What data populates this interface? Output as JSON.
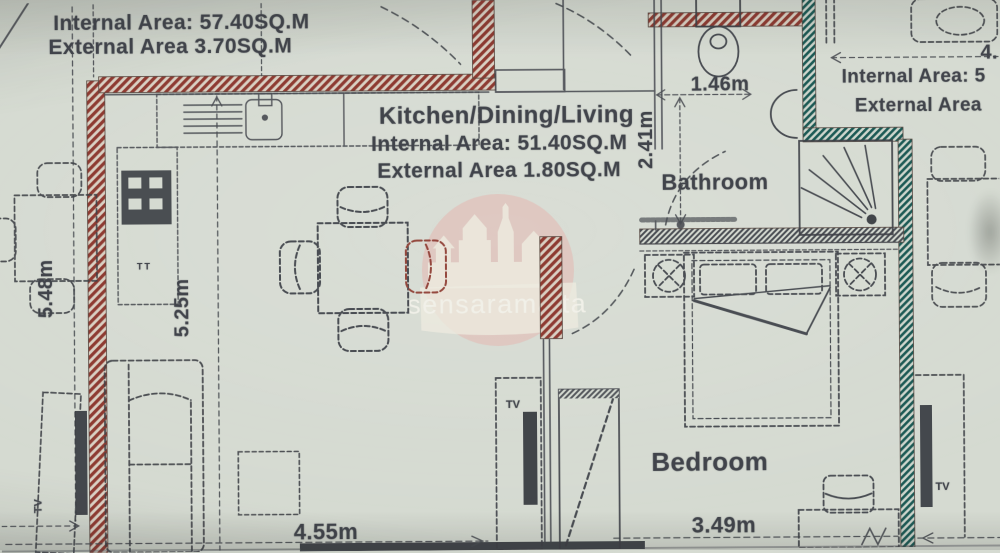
{
  "watermark": {
    "text": "sensaramalta"
  },
  "left_block": {
    "internal": "Internal Area: 57.40SQ.M",
    "external": "External Area 3.70SQ.M"
  },
  "kitchen": {
    "title": "Kitchen/Dining/Living",
    "internal": "Internal Area: 51.40SQ.M",
    "external": "External Area 1.80SQ.M"
  },
  "bathroom": {
    "label": "Bathroom"
  },
  "bedroom": {
    "label": "Bedroom"
  },
  "right_block": {
    "internal": "Internal Area: 5",
    "external": "External Area",
    "dim_partial": "4."
  },
  "dims": {
    "bath_width": "1.46m",
    "bath_depth": "2.41m",
    "terrace_len": "5.48m",
    "living_len": "5.25m",
    "living_width": "4.55m",
    "bedroom_width": "3.49m"
  },
  "labels": {
    "tv": "TV",
    "tt": "TT"
  },
  "colors": {
    "paper": "#d5dad1",
    "ink": "#494c52",
    "wall_red": "#8e3b31",
    "wall_teal": "#1e5a55",
    "watermark_pink": "#e5b3ae"
  }
}
